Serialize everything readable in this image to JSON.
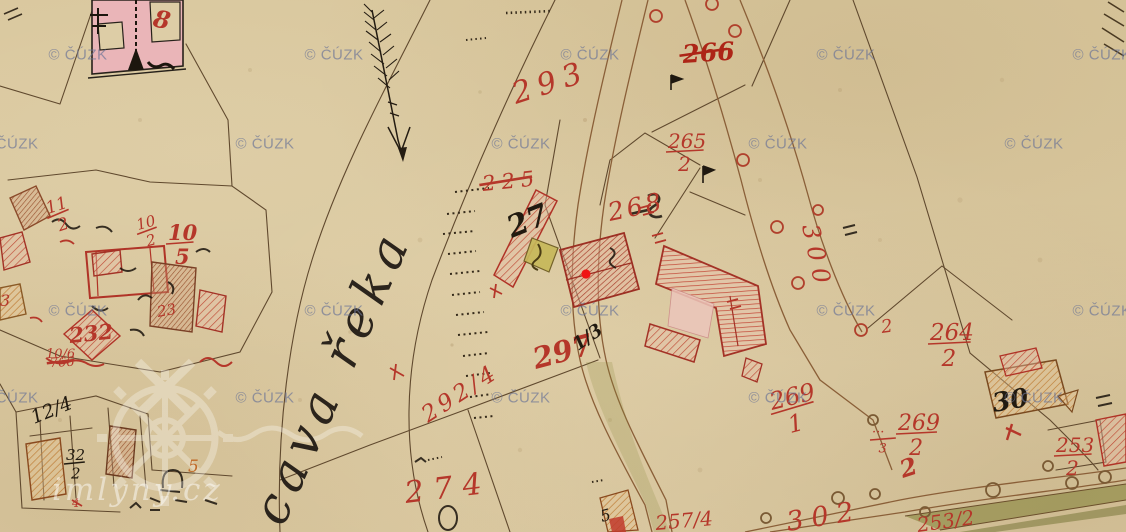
{
  "colors": {
    "parcel_red": "#b5372a",
    "ink_black": "#211a10",
    "line_brown": "#60492e",
    "road_brown": "#8a5f38",
    "orange": "#c06a28",
    "marker_red": "#f01515",
    "watermark_gray_blue": "#6c7496",
    "paper": "#d9c89f",
    "green_band": "#7f7f35"
  },
  "watermarks": {
    "label": "© ČÚZK",
    "positions": [
      {
        "x": 78,
        "y": 55
      },
      {
        "x": 334,
        "y": 55
      },
      {
        "x": 590,
        "y": 55
      },
      {
        "x": 846,
        "y": 55
      },
      {
        "x": 1102,
        "y": 55
      },
      {
        "x": 9,
        "y": 144
      },
      {
        "x": 265,
        "y": 144
      },
      {
        "x": 521,
        "y": 144
      },
      {
        "x": 778,
        "y": 144
      },
      {
        "x": 1034,
        "y": 144
      },
      {
        "x": 78,
        "y": 311
      },
      {
        "x": 334,
        "y": 311
      },
      {
        "x": 590,
        "y": 311
      },
      {
        "x": 846,
        "y": 311
      },
      {
        "x": 1102,
        "y": 311
      },
      {
        "x": 9,
        "y": 398
      },
      {
        "x": 265,
        "y": 398
      },
      {
        "x": 521,
        "y": 398
      },
      {
        "x": 778,
        "y": 398
      },
      {
        "x": 1034,
        "y": 398
      }
    ]
  },
  "brand": {
    "label": "imlyny.cz"
  },
  "river": {
    "label": "cava řeka"
  },
  "marker": {
    "x": 586,
    "y": 274
  },
  "parcel_labels": [
    {
      "t": "8",
      "x": 152,
      "y": 26,
      "s": 24,
      "rot": 12,
      "b": true
    },
    {
      "t": "293",
      "x": 516,
      "y": 104,
      "s": 30,
      "rot": -18,
      "sp": 7
    },
    {
      "t": "266",
      "x": 683,
      "y": 63,
      "s": 25,
      "rot": -4,
      "b": true,
      "strike": true,
      "c": "#ad2517"
    },
    {
      "num": "265",
      "den": "2",
      "x": 668,
      "y": 148,
      "s": 20
    },
    {
      "t": "268",
      "x": 610,
      "y": 221,
      "s": 25,
      "rot": -12,
      "sp": 3
    },
    {
      "t": "225",
      "x": 483,
      "y": 191,
      "s": 21,
      "rot": -6,
      "sp": 6,
      "strike": true
    },
    {
      "t": "27",
      "x": 512,
      "y": 238,
      "s": 30,
      "rot": -22,
      "b": true,
      "c": "#211a10"
    },
    {
      "t": "297",
      "x": 536,
      "y": 369,
      "s": 29,
      "rot": -15,
      "b": true
    },
    {
      "t": "1/3",
      "x": 578,
      "y": 351,
      "s": 18,
      "rot": -35,
      "b": true,
      "c": "#211a10"
    },
    {
      "t": "292/4",
      "x": 428,
      "y": 423,
      "s": 23,
      "rot": -33,
      "sp": 4
    },
    {
      "t": "274",
      "x": 406,
      "y": 503,
      "s": 30,
      "rot": -7,
      "sp": 10
    },
    {
      "num": "269",
      "den": "1",
      "x": 772,
      "y": 410,
      "s": 24,
      "rot": -14
    },
    {
      "num": "269",
      "den": "2",
      "x": 898,
      "y": 430,
      "s": 22
    },
    {
      "num": "···",
      "den": "3",
      "x": 872,
      "y": 436,
      "s": 13
    },
    {
      "t": "2",
      "x": 903,
      "y": 478,
      "s": 24,
      "rot": -18,
      "b": true
    },
    {
      "t": "2",
      "x": 882,
      "y": 333,
      "s": 18,
      "rot": -8
    },
    {
      "num": "264",
      "den": "2",
      "x": 930,
      "y": 340,
      "s": 23
    },
    {
      "t": "300",
      "x": 802,
      "y": 226,
      "s": 24,
      "rot": 78,
      "sp": 7
    },
    {
      "t": "302",
      "x": 788,
      "y": 531,
      "s": 27,
      "rot": -9,
      "sp": 8
    },
    {
      "num": "253",
      "den": "2",
      "x": 1056,
      "y": 452,
      "s": 20
    },
    {
      "t": "253/2",
      "x": 918,
      "y": 532,
      "s": 20,
      "rot": -8
    },
    {
      "t": "257/4",
      "x": 656,
      "y": 530,
      "s": 20,
      "rot": -5
    },
    {
      "t": "30",
      "x": 994,
      "y": 412,
      "s": 26,
      "rot": -10,
      "b": true,
      "c": "#211a10"
    },
    {
      "num": "11",
      "den": "2",
      "x": 48,
      "y": 214,
      "s": 17,
      "rot": -18
    },
    {
      "num": "10",
      "den": "2",
      "x": 138,
      "y": 230,
      "s": 15,
      "rot": -15
    },
    {
      "num": "10",
      "den": "5",
      "x": 168,
      "y": 240,
      "s": 21,
      "b": true
    },
    {
      "t": "232",
      "x": 70,
      "y": 343,
      "s": 21,
      "rot": -6,
      "b": true
    },
    {
      "t": "23",
      "x": 158,
      "y": 317,
      "s": 15,
      "rot": -10
    },
    {
      "t": "10/6",
      "x": 46,
      "y": 358,
      "s": 13
    },
    {
      "t": "3",
      "x": 0,
      "y": 306,
      "s": 16
    },
    {
      "t": "766",
      "x": 50,
      "y": 367,
      "s": 13,
      "rot": -3,
      "strike": true
    },
    {
      "t": "12/4",
      "x": 34,
      "y": 424,
      "s": 19,
      "rot": -22,
      "c": "#211a10"
    },
    {
      "num": "32",
      "den": "2",
      "x": 66,
      "y": 460,
      "s": 15,
      "c": "#211a10"
    },
    {
      "t": "4",
      "x": 72,
      "y": 507,
      "s": 12
    },
    {
      "t": "5",
      "x": 188,
      "y": 472,
      "s": 17,
      "c": "#c06a28"
    },
    {
      "t": "5",
      "x": 602,
      "y": 522,
      "s": 16,
      "rot": -15,
      "c": "#211a10"
    }
  ]
}
